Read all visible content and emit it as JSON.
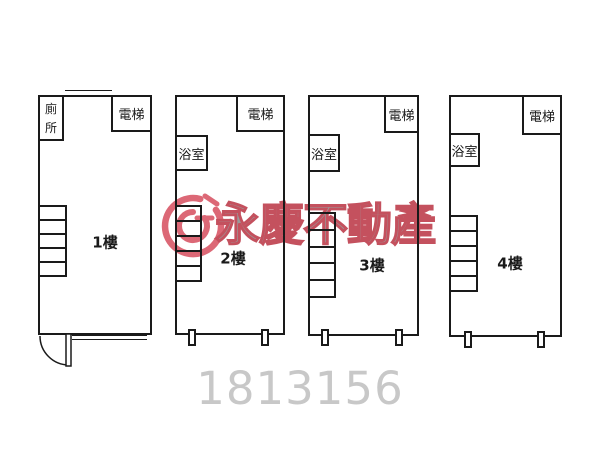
{
  "canvas": {
    "background": "#ffffff",
    "line_color": "#1a1a1a"
  },
  "diagram": {
    "type": "building-floorplan",
    "floors": [
      {
        "label": "1樓",
        "rooms": {
          "toilet": "廁所",
          "elevator": "電梯"
        }
      },
      {
        "label": "2樓",
        "rooms": {
          "bathroom": "浴室",
          "elevator": "電梯"
        }
      },
      {
        "label": "3樓",
        "rooms": {
          "bathroom": "浴室",
          "elevator": "電梯"
        }
      },
      {
        "label": "4樓",
        "rooms": {
          "bathroom": "浴室",
          "elevator": "電梯"
        }
      }
    ]
  },
  "watermark": {
    "logo": "yungching-g-logo",
    "brand_text": "永慶不動產",
    "brand_text_color": "#9a9a9a",
    "brand_outline_color": "#c4515e",
    "logo_color": "#d95868",
    "listing_number": "1813156",
    "listing_number_color": "#c8c8c8"
  }
}
